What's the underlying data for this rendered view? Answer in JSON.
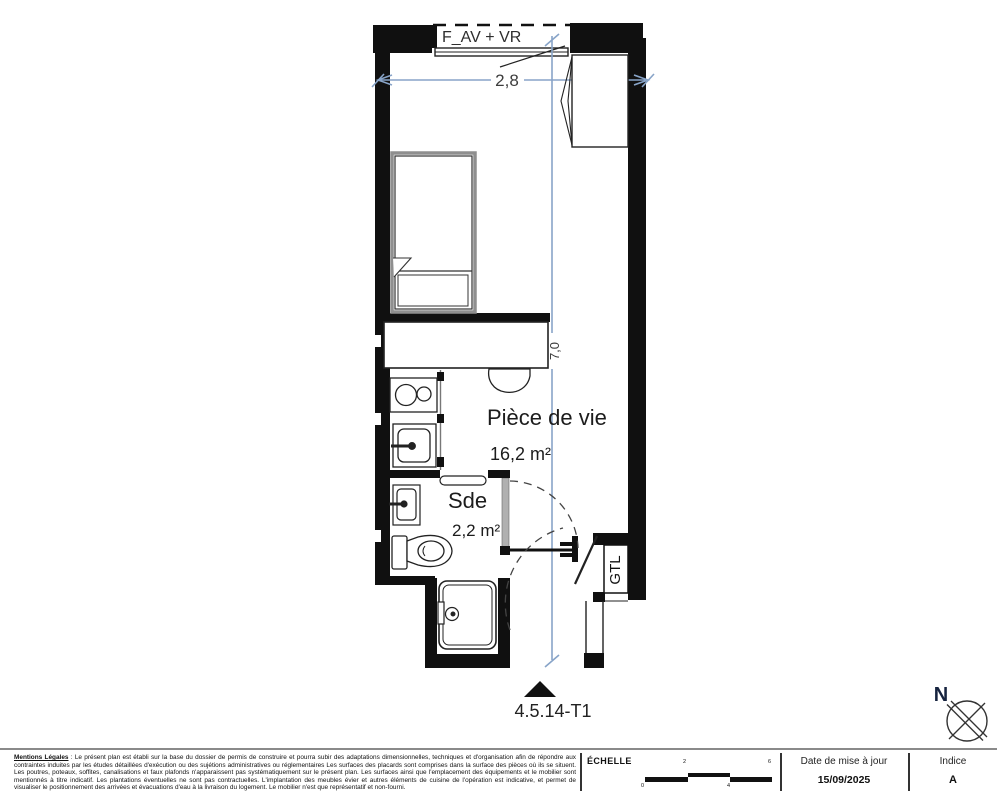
{
  "plan": {
    "window_label": "F_AV + VR",
    "width_dim": "2,8",
    "length_dim": "7,0",
    "rooms": {
      "living": {
        "name": "Pièce de vie",
        "area": "16,2 m²"
      },
      "shower": {
        "name": "Sde",
        "area": "2,2 m²"
      }
    },
    "gtl_label": "GTL",
    "unit_label": "4.5.14-T1",
    "north_label": "N",
    "accent_color": "#88a4c8"
  },
  "footer": {
    "legal": {
      "title": "Mentions Légales",
      "body": " : Le présent plan est établi sur la base du dossier de permis de construire et pourra subir des adaptations dimensionnelles, techniques et d'organisation afin de répondre aux contraintes induites par les études détaillées d'exécution ou des sujétions administratives ou réglementaires Les surfaces des placards sont comprises dans la surface des pièces où ils se situent. Les poutres, poteaux, soffites, canalisations et faux plafonds n'apparaissent pas systématiquement sur le présent plan. Les surfaces ainsi que l'emplacement des équipements et le mobilier sont mentionnés à titre indicatif. Les plantations éventuelles ne sont pas contractuelles. L'implantation des meubles évier et autres éléments de cuisine de l'opération est indicative, et permet de visualiser le positionnement des arrivées et évacuations d'eau à la livraison du logement. Le mobilier n'est que représentatif et non-fourni."
    },
    "scale": {
      "label": "ÉCHELLE",
      "tick_top_1": "2",
      "tick_top_2": "6",
      "tick_bottom_1": "0",
      "tick_bottom_2": "4"
    },
    "date": {
      "label": "Date de mise à jour",
      "value": "15/09/2025"
    },
    "indice": {
      "label": "Indice",
      "value": "A"
    }
  }
}
